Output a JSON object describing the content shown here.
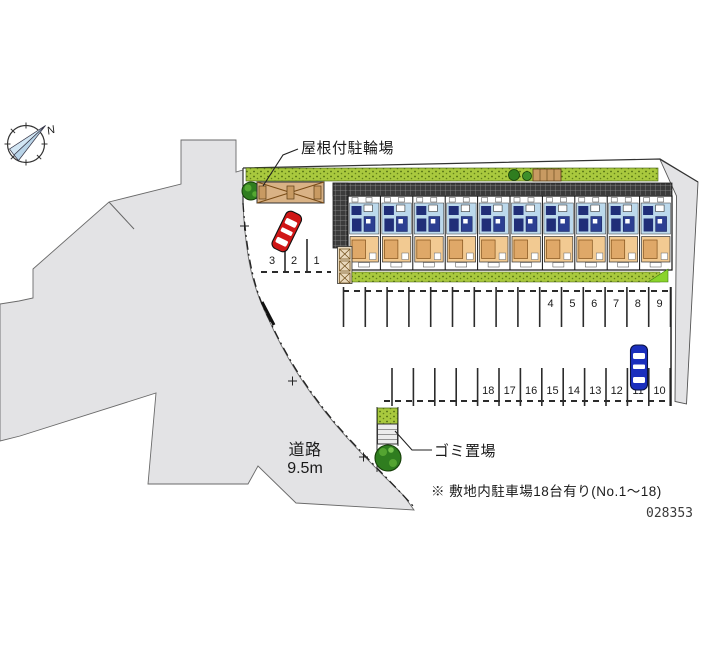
{
  "compass": {
    "north_label": "N"
  },
  "labels": {
    "bicycle_parking": "屋根付駐輪場",
    "garbage": "ゴミ置場",
    "road": "道路",
    "road_width": "9.5m"
  },
  "note": "※ 敷地内駐車場18台有り(No.1～18)",
  "plan_number": "028353",
  "parking": {
    "left_row": [
      "3",
      "2",
      "1"
    ],
    "upper_row": [
      "4",
      "5",
      "6",
      "7",
      "8",
      "9"
    ],
    "lower_row": [
      "18",
      "17",
      "16",
      "15",
      "14",
      "13",
      "12",
      "11",
      "10"
    ]
  },
  "building": {
    "unit_count": 10
  },
  "colors": {
    "road": "#e3e3e5",
    "hedge": "#a9c93e",
    "tree": "#2f7d1f",
    "bike_shed": "#d9b285",
    "unit_blue": "#bcd9ec",
    "unit_tan": "#f2ca92",
    "fixture_navy": "#202e78",
    "furniture_tan": "#dfa868",
    "corridor": "#3b3b3b",
    "red_car": "#d01616",
    "blue_car": "#1b2fbd",
    "accent_green": "#8ad32b"
  }
}
